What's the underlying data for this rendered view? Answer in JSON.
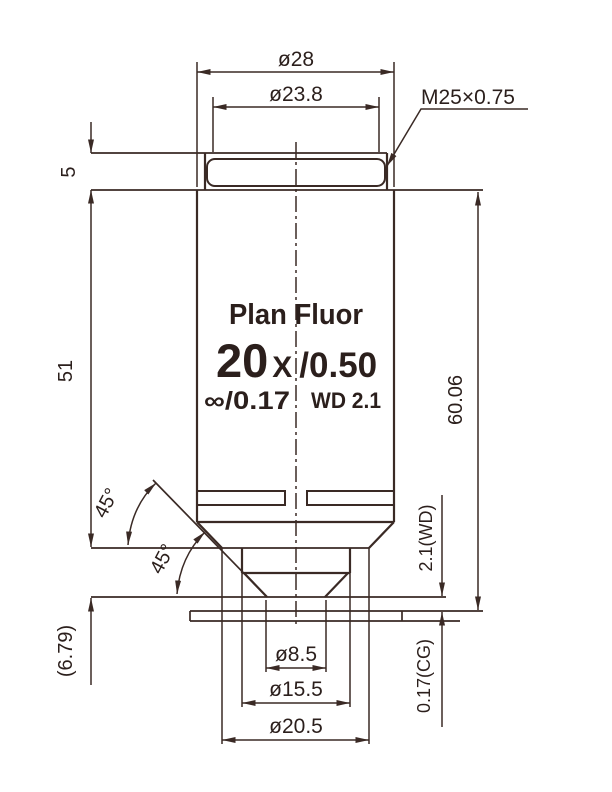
{
  "colors": {
    "line": "#3a2a25",
    "text": "#2b1f1c",
    "background": "#ffffff"
  },
  "dimensions": {
    "outer_diameter": "ø28",
    "thread_pilot_diameter": "ø23.8",
    "thread_spec": "M25×0.75",
    "thread_length": "5",
    "barrel_length": "51",
    "parfocal_length": "60.06",
    "tip_protrusion": "(6.79)",
    "shoulder_angle": "45°",
    "tip_angle": "45°",
    "working_distance_note": "2.1(WD)",
    "cover_glass_note": "0.17(CG)",
    "front_aperture_diameter": "ø8.5",
    "nose_diameter": "ø15.5",
    "taper_flat_diameter": "ø20.5"
  },
  "body_markings": {
    "series": "Plan Fluor",
    "magnification": "20",
    "mag_suffix": "X",
    "numerical_aperture": "/0.50",
    "tube_length_cover": "∞/0.17",
    "working_distance": "WD 2.1"
  }
}
